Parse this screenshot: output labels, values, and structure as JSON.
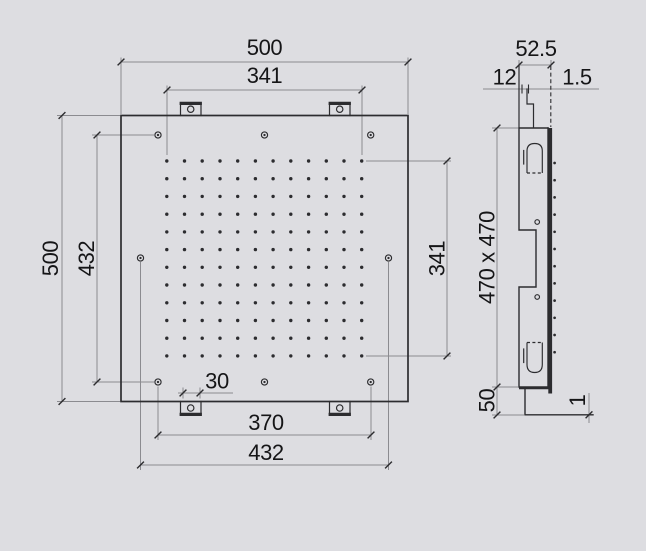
{
  "colors": {
    "background": "#dddde1",
    "line": "#2c2c2f",
    "dimension": "#8b8b90",
    "text": "#151517"
  },
  "front_view": {
    "dimensions": {
      "outer_width": "500",
      "nozzle_field_width": "341",
      "outer_height": "500",
      "fixing_hole_pitch_vertical": "432",
      "nozzle_field_height": "341",
      "bracket_width": "30",
      "bracket_hole_pitch": "370",
      "fixing_hole_pitch_horizontal": "432"
    },
    "nozzle_grid": {
      "rows": 12,
      "cols": 12
    },
    "mounting_hole_count": 8
  },
  "side_view": {
    "dimensions": {
      "total_depth": "52.5",
      "bracket_depth": "12",
      "plate_gap": "1.5",
      "housing_size": "470 x 470",
      "collar_height": "50",
      "plate_thickness": "1"
    }
  }
}
